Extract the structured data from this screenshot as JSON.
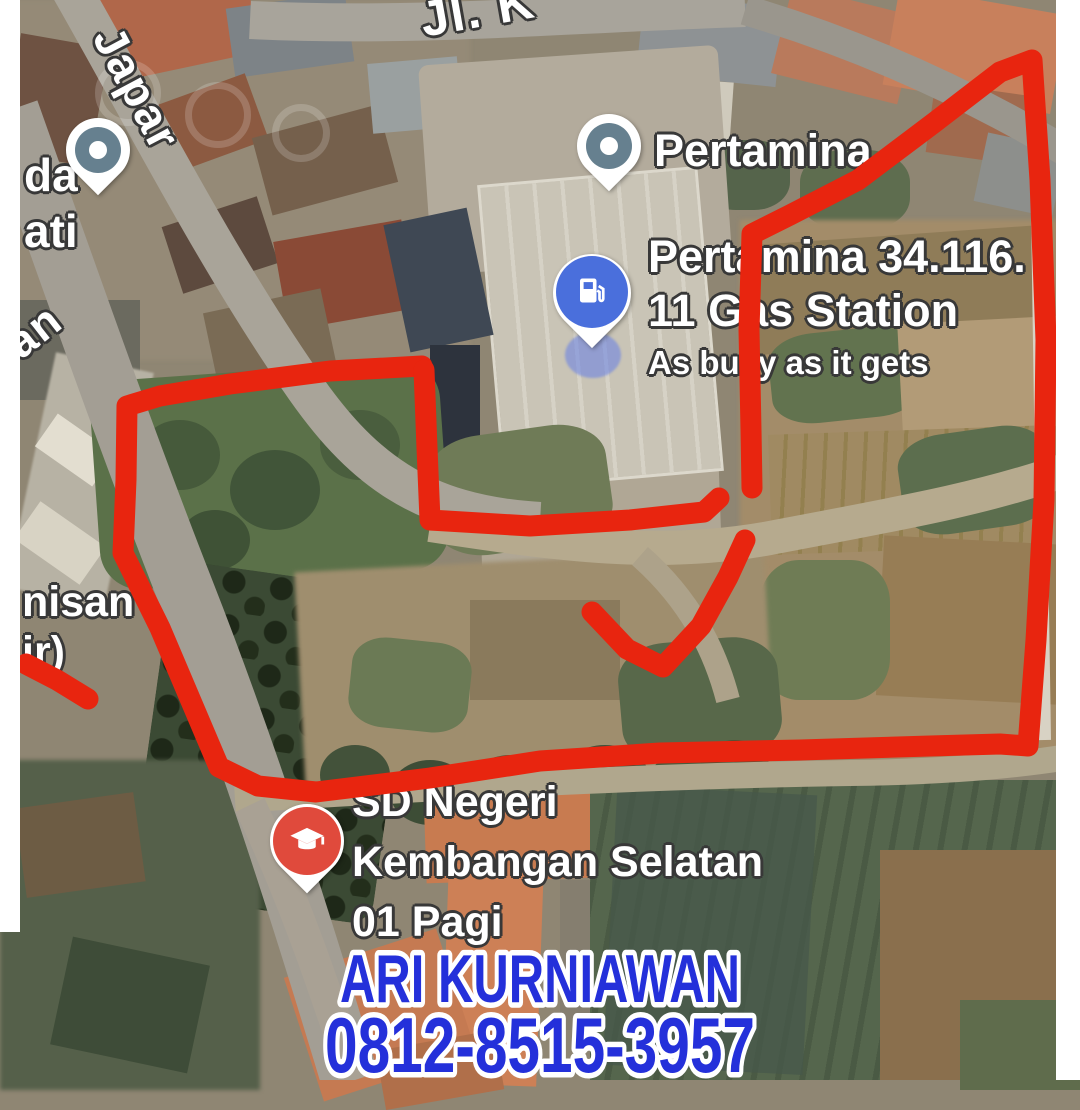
{
  "map": {
    "road_labels": [
      {
        "text": "Jl. K"
      },
      {
        "text": "Japar"
      },
      {
        "text": "an"
      }
    ],
    "cut_labels": {
      "top_left": [
        "da",
        "ati"
      ],
      "mid_left": [
        "nisan",
        "ir)"
      ]
    },
    "pois": [
      {
        "name": "Pertamina",
        "pin": "generic-place-pin"
      },
      {
        "lines": [
          "Pertamina 34.116.",
          "11 Gas Station"
        ],
        "subtitle": "As busy as it gets",
        "pin": "gas-station-pin"
      },
      {
        "lines": [
          "SD Negeri",
          "Kembangan Selatan",
          "01 Pagi"
        ],
        "pin": "school-pin"
      }
    ],
    "pin_colors": {
      "generic": "#66808f",
      "gas": "#4a6fdc",
      "gas_halo": "rgba(100,125,230,0.55)",
      "school": "#e04a3c"
    }
  },
  "annotations": {
    "color": "#e8250f",
    "stroke_width": 21,
    "segments": [
      [
        [
          422,
          366
        ],
        [
          330,
          371
        ],
        [
          230,
          384
        ],
        [
          160,
          396
        ],
        [
          127,
          406
        ],
        [
          126,
          480
        ],
        [
          123,
          553
        ],
        [
          160,
          628
        ],
        [
          219,
          767
        ],
        [
          258,
          786
        ],
        [
          316,
          792
        ],
        [
          430,
          778
        ],
        [
          540,
          761
        ],
        [
          660,
          753
        ],
        [
          800,
          750
        ],
        [
          930,
          746
        ],
        [
          1000,
          744
        ],
        [
          1028,
          746
        ],
        [
          1036,
          640
        ],
        [
          1044,
          500
        ],
        [
          1046,
          340
        ],
        [
          1040,
          180
        ],
        [
          1032,
          60
        ],
        [
          1000,
          72
        ],
        [
          935,
          122
        ],
        [
          858,
          180
        ],
        [
          790,
          215
        ],
        [
          752,
          234
        ],
        [
          749,
          330
        ],
        [
          751,
          430
        ],
        [
          752,
          488
        ]
      ],
      [
        [
          424,
          370
        ],
        [
          427,
          448
        ],
        [
          430,
          520
        ],
        [
          530,
          526
        ],
        [
          630,
          520
        ],
        [
          704,
          512
        ],
        [
          719,
          498
        ]
      ],
      [
        [
          592,
          612
        ],
        [
          627,
          649
        ],
        [
          663,
          667
        ],
        [
          701,
          626
        ],
        [
          728,
          577
        ],
        [
          745,
          540
        ]
      ],
      [
        [
          26,
          664
        ],
        [
          57,
          680
        ],
        [
          88,
          699
        ]
      ]
    ]
  },
  "contact": {
    "name": "ARI KURNIAWAN",
    "phone": "0812-8515-3957",
    "color": "#2430da"
  }
}
